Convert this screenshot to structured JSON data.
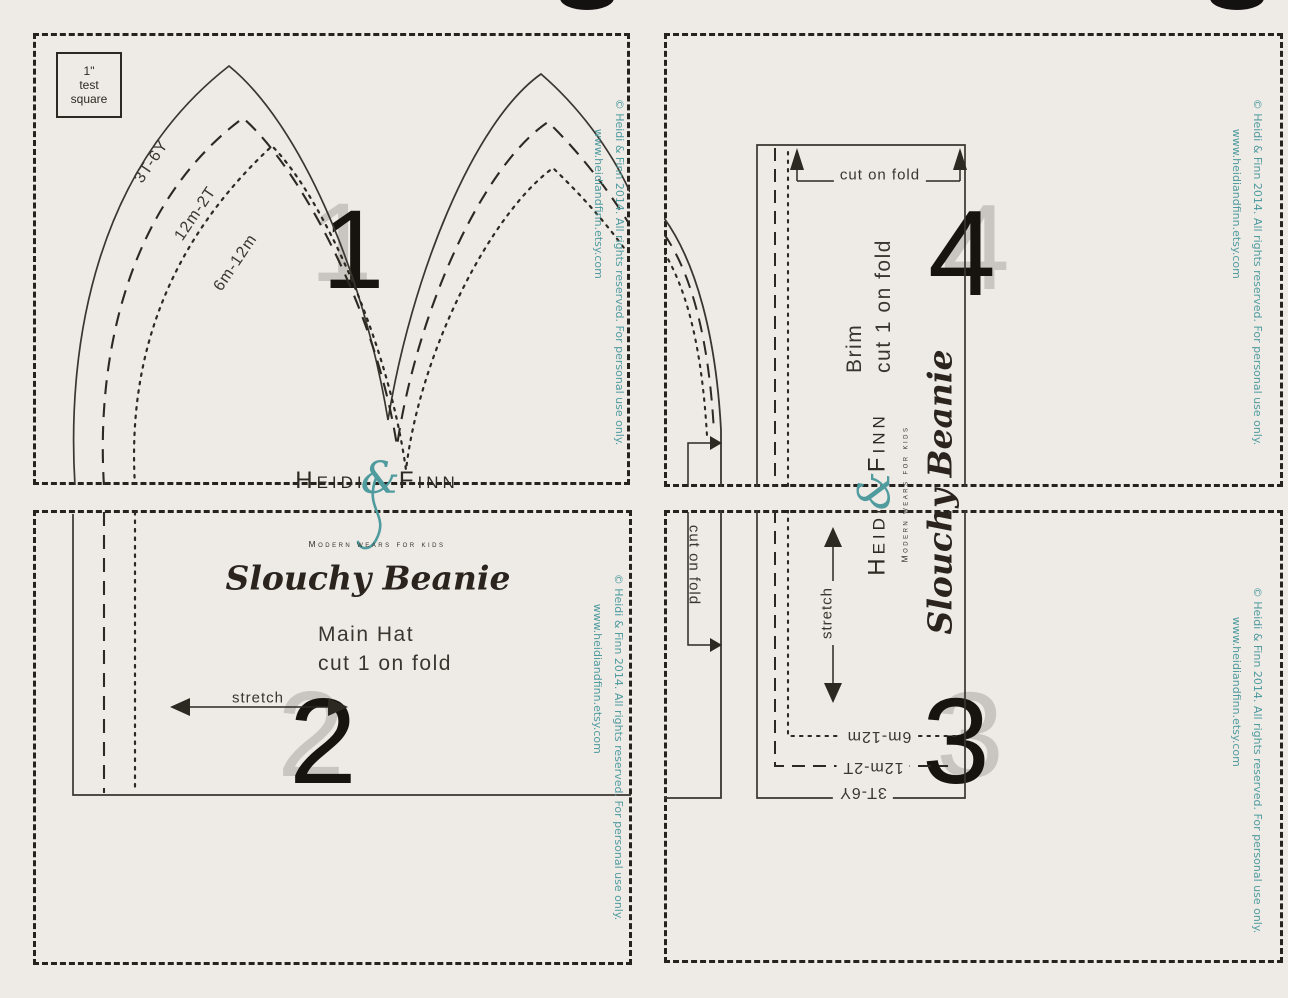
{
  "test_square": {
    "line1": "1\"",
    "line2": "test",
    "line3": "square"
  },
  "sizes": {
    "large": "3T-6Y",
    "medium": "12m-2T",
    "small": "6m-12m"
  },
  "pages": {
    "page1": "1",
    "page2": "2",
    "page3": "3",
    "page4": "4"
  },
  "brand": {
    "name_first": "Heidi",
    "ampersand": "&",
    "name_last": "Finn",
    "tagline": "Modern wears for kids"
  },
  "pattern": {
    "title": "Slouchy Beanie",
    "main_piece": "Main Hat",
    "main_cut": "cut 1 on fold",
    "brim_piece": "Brim",
    "brim_cut": "cut 1 on fold",
    "stretch": "stretch",
    "cut_on_fold": "cut on fold"
  },
  "copyright": {
    "line1": "© Heidi & Finn 2014.  All rights reserved. For personal use only.",
    "line2": "www.heidiandfinn.etsy.com"
  },
  "colors": {
    "background": "#eeebe7",
    "line": "#3a352e",
    "teal": "#4f9b9e",
    "number": "#17130f",
    "number_shadow": "#c9c5c0"
  }
}
